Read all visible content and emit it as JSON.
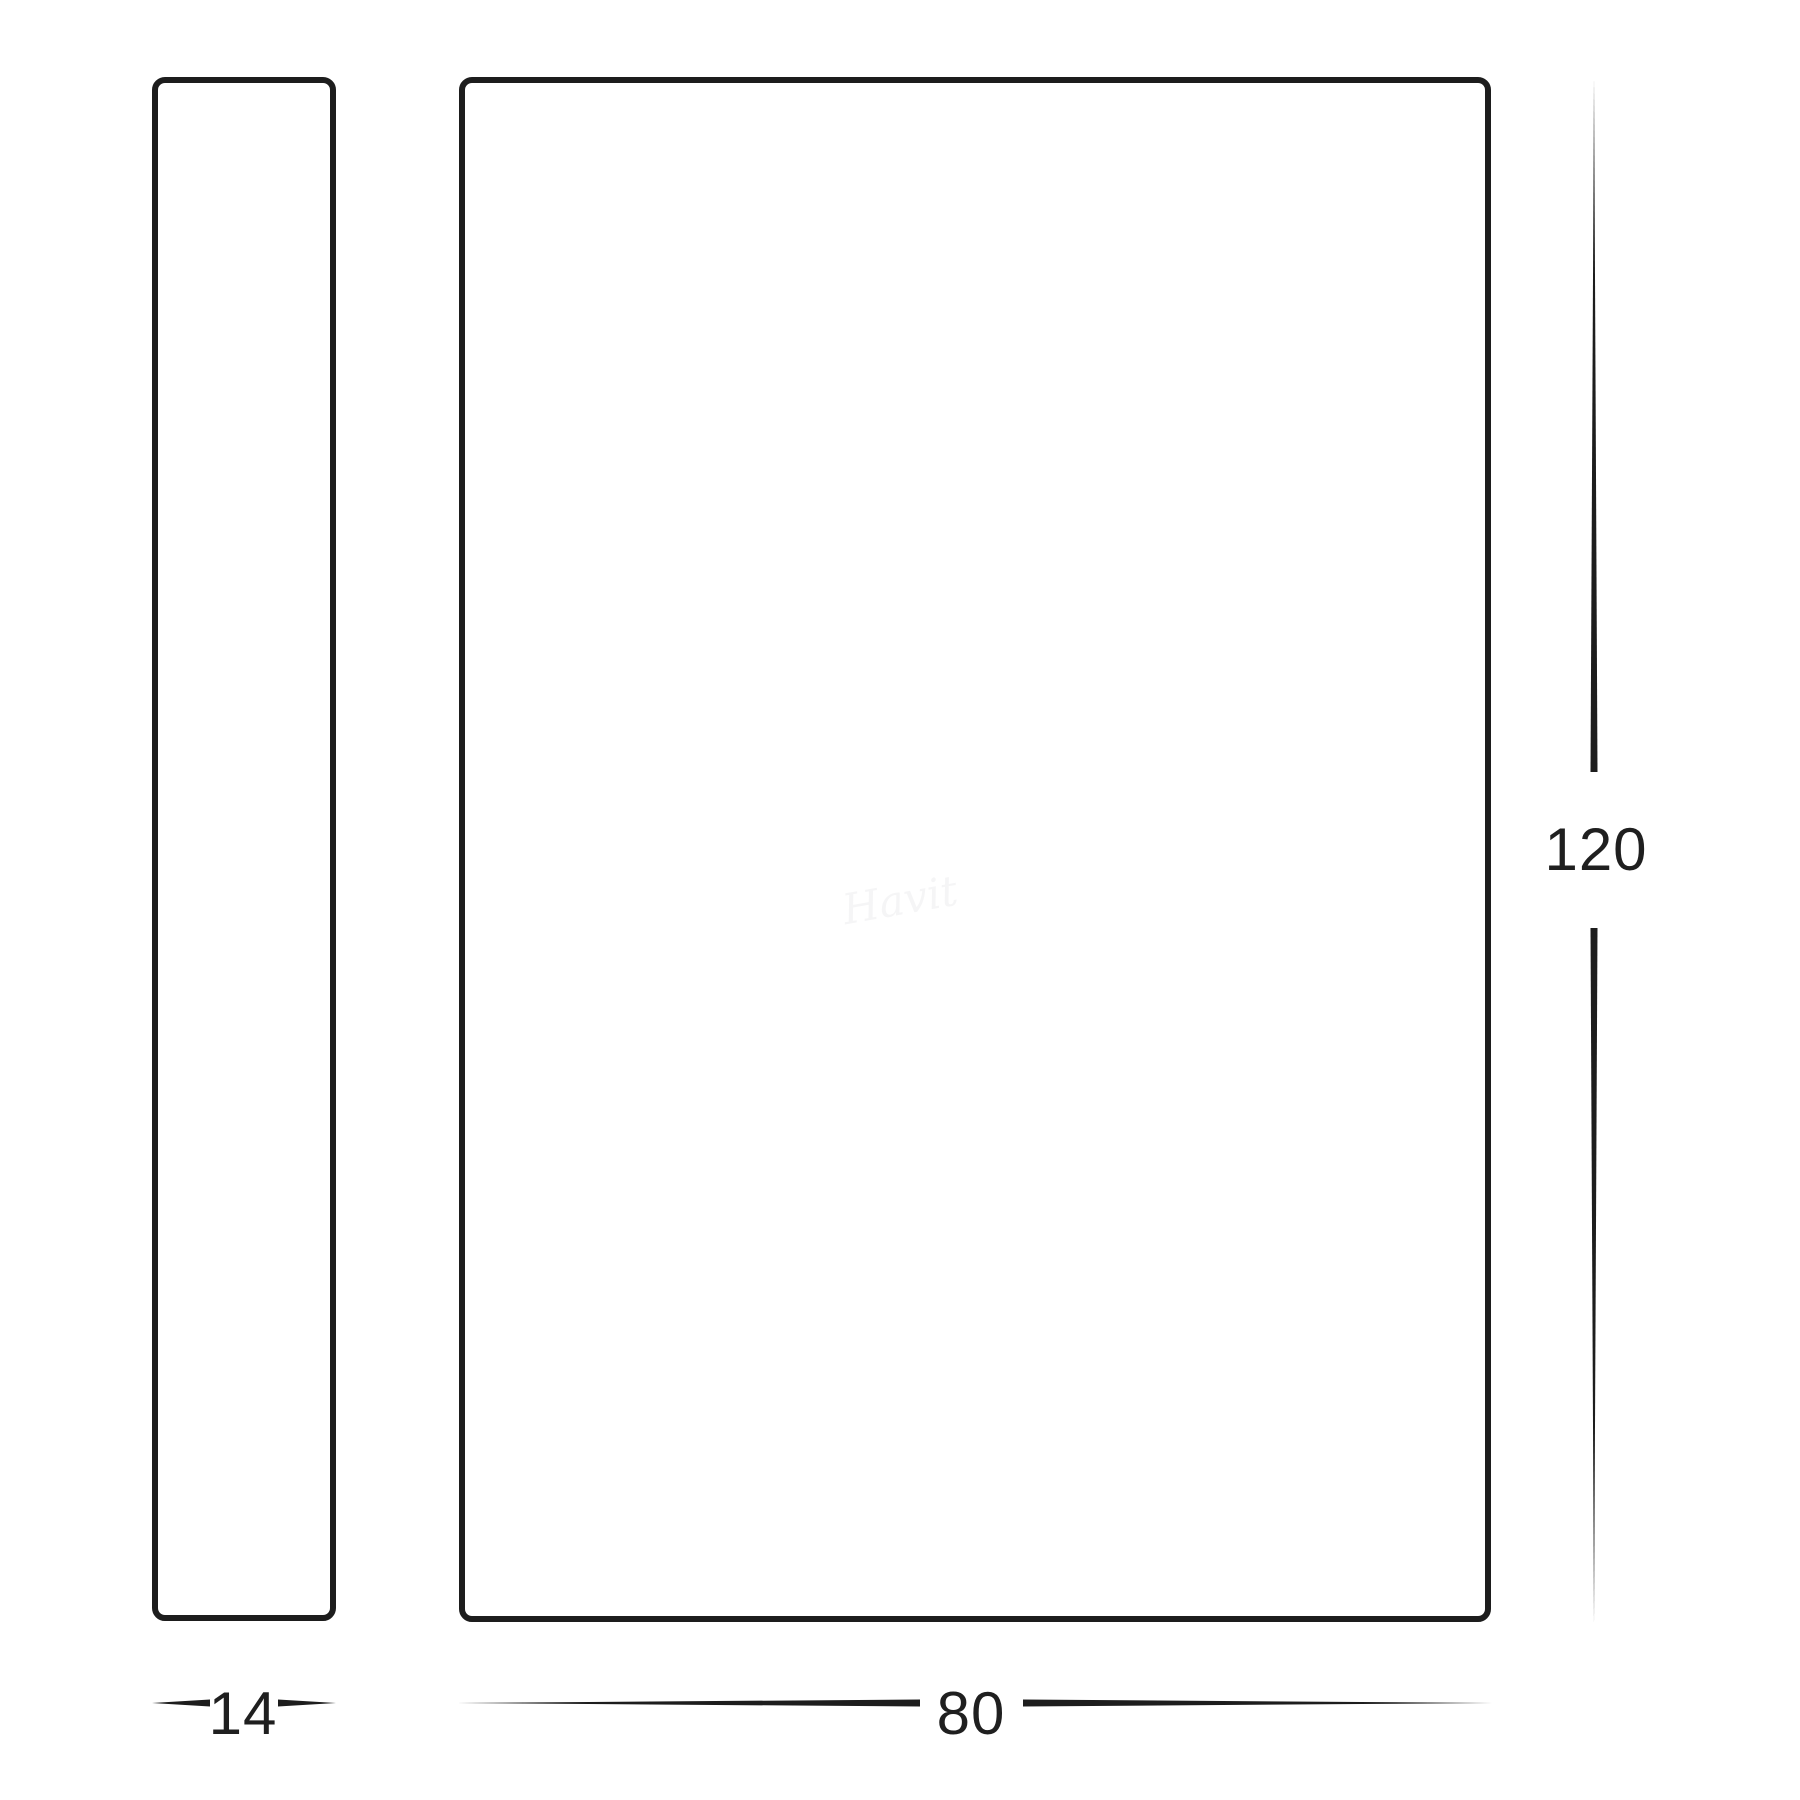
{
  "diagram": {
    "type": "product-dimension-drawing",
    "views": {
      "side_profile": "side view outline",
      "front": "front view outline"
    },
    "dimensions": {
      "depth": "14",
      "width": "80",
      "height": "120"
    },
    "watermark": "Havit",
    "colors": {
      "line": "#1d1d1d",
      "text": "#1f1f1f",
      "background": "#ffffff"
    }
  }
}
